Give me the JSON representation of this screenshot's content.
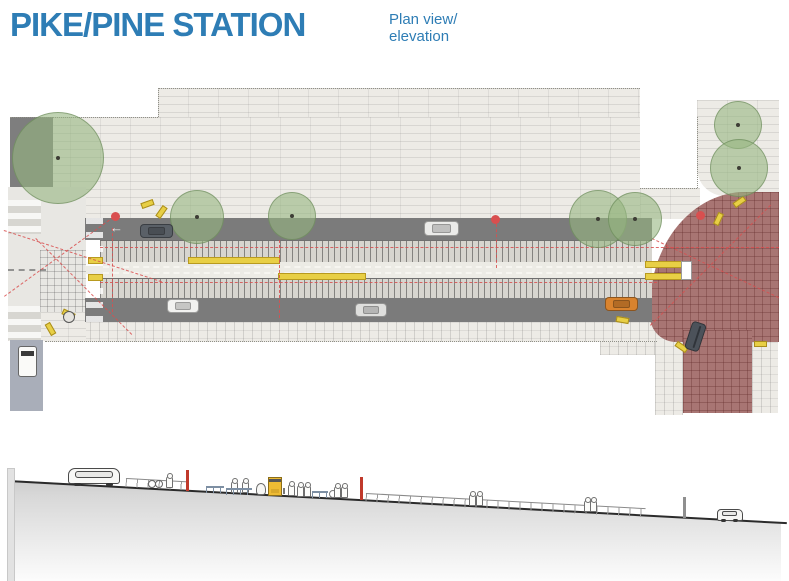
{
  "header": {
    "title": "PIKE/PINE STATION",
    "subtitle_line1": "Plan view/",
    "subtitle_line2": "elevation"
  },
  "colors": {
    "blue": "#2e7db5",
    "road": "#7b7b7b",
    "redzone": "#a87573",
    "redline": "#d94f4f",
    "yellow": "#e8cf45",
    "tree": "rgba(150,181,128,0.6)"
  },
  "plan": {
    "trees": [
      {
        "type": "tree",
        "name": "street-tree",
        "x": 57,
        "y": 157,
        "r": 45
      },
      {
        "type": "tree",
        "name": "street-tree",
        "x": 196,
        "y": 216,
        "r": 26
      },
      {
        "type": "tree",
        "name": "street-tree",
        "x": 291,
        "y": 215,
        "r": 23
      },
      {
        "type": "tree",
        "name": "street-tree",
        "x": 597,
        "y": 218,
        "r": 28
      },
      {
        "type": "tree",
        "name": "street-tree",
        "x": 634,
        "y": 218,
        "r": 26
      },
      {
        "type": "tree",
        "name": "street-tree",
        "x": 737,
        "y": 124,
        "r": 23
      },
      {
        "type": "tree",
        "name": "street-tree",
        "x": 738,
        "y": 167,
        "r": 28
      }
    ],
    "vehicles": [
      {
        "type": "car",
        "name": "car-plan",
        "x": 140,
        "y": 224,
        "w": 31,
        "h": 12,
        "color": "#5a6067"
      },
      {
        "type": "arrow",
        "name": "lane-arrow-left",
        "x": 110,
        "y": 221,
        "text": "←"
      },
      {
        "type": "car",
        "name": "car-plan",
        "x": 424,
        "y": 221,
        "w": 33,
        "h": 13,
        "color": "#ebebe9"
      },
      {
        "type": "car",
        "name": "car-plan",
        "x": 167,
        "y": 299,
        "w": 30,
        "h": 12,
        "color": "#f2f2f0"
      },
      {
        "type": "car",
        "name": "car-plan",
        "x": 355,
        "y": 303,
        "w": 30,
        "h": 12,
        "color": "#dfdfdd"
      },
      {
        "type": "car",
        "name": "car-plan",
        "x": 605,
        "y": 297,
        "w": 31,
        "h": 12,
        "color": "#d9832e"
      },
      {
        "type": "car",
        "name": "car-plan-turning",
        "x": 688,
        "y": 322,
        "w": 13,
        "h": 27,
        "rot": 18,
        "color": "#4c525a"
      },
      {
        "type": "truck",
        "name": "truck-plan",
        "x": 18,
        "y": 346,
        "w": 17,
        "h": 29,
        "color": "#fafaf8"
      }
    ],
    "marks": [
      {
        "type": "dot",
        "name": "signal-dot",
        "x": 115,
        "y": 216
      },
      {
        "type": "dot",
        "name": "signal-dot",
        "x": 495,
        "y": 219
      },
      {
        "type": "dot",
        "name": "signal-dot",
        "x": 700,
        "y": 215
      },
      {
        "type": "ramp",
        "name": "curb-ramp",
        "x": 141,
        "y": 201,
        "rot": -20
      },
      {
        "type": "ramp",
        "name": "curb-ramp",
        "x": 155,
        "y": 209,
        "rot": -55
      },
      {
        "type": "ramp",
        "name": "curb-ramp",
        "x": 62,
        "y": 311,
        "rot": 25
      },
      {
        "type": "ramp",
        "name": "curb-ramp",
        "x": 44,
        "y": 326,
        "rot": 60
      },
      {
        "type": "ramp",
        "name": "curb-ramp",
        "x": 616,
        "y": 317,
        "rot": 10
      },
      {
        "type": "ramp",
        "name": "curb-ramp",
        "x": 675,
        "y": 344,
        "rot": 35
      },
      {
        "type": "ramp",
        "name": "curb-ramp",
        "x": 754,
        "y": 341,
        "rot": 0
      },
      {
        "type": "ramp",
        "name": "curb-ramp",
        "x": 733,
        "y": 199,
        "rot": -35
      },
      {
        "type": "ramp",
        "name": "curb-ramp",
        "x": 712,
        "y": 216,
        "rot": -65
      },
      {
        "type": "manhole",
        "name": "manhole",
        "x": 63,
        "y": 311
      }
    ]
  },
  "elevation": {
    "items": [
      {
        "type": "car-rear",
        "name": "vehicle-elevation-left",
        "x": 68,
        "y": 468,
        "w": 50,
        "h": 14
      },
      {
        "type": "railing",
        "name": "railing",
        "x": 126,
        "y": 478,
        "w": 62,
        "rot": 3.1
      },
      {
        "type": "cyclist",
        "name": "cyclist",
        "x": 148,
        "y": 479
      },
      {
        "type": "fig",
        "name": "person",
        "x": 166,
        "y": 476
      },
      {
        "type": "pole",
        "name": "signal-pole-red",
        "x": 186,
        "y": 470,
        "h": 21,
        "color": "#c0392b"
      },
      {
        "type": "bench",
        "name": "bench",
        "x": 206,
        "y": 486,
        "w": 18
      },
      {
        "type": "fig",
        "name": "person",
        "x": 231,
        "y": 481
      },
      {
        "type": "fig",
        "name": "person",
        "x": 242,
        "y": 481
      },
      {
        "type": "bench",
        "name": "bench",
        "x": 226,
        "y": 488,
        "w": 26
      },
      {
        "type": "fig-round",
        "name": "person",
        "x": 256,
        "y": 483
      },
      {
        "type": "kiosk",
        "name": "ticket-kiosk",
        "x": 268,
        "y": 477
      },
      {
        "type": "post",
        "name": "bollard",
        "x": 283,
        "y": 488
      },
      {
        "type": "fig",
        "name": "person",
        "x": 288,
        "y": 484
      },
      {
        "type": "fig",
        "name": "person",
        "x": 297,
        "y": 485
      },
      {
        "type": "fig",
        "name": "person",
        "x": 304,
        "y": 485
      },
      {
        "type": "bench",
        "name": "bench",
        "x": 312,
        "y": 491,
        "w": 16
      },
      {
        "type": "bikes",
        "name": "bike-rack",
        "x": 329,
        "y": 490
      },
      {
        "type": "fig",
        "name": "person",
        "x": 334,
        "y": 486
      },
      {
        "type": "fig",
        "name": "person",
        "x": 341,
        "y": 486
      },
      {
        "type": "pole",
        "name": "signal-pole-red",
        "x": 360,
        "y": 477,
        "h": 23,
        "color": "#c0392b"
      },
      {
        "type": "railing",
        "name": "railing",
        "x": 366,
        "y": 493,
        "w": 280,
        "rot": 3.1
      },
      {
        "type": "fig",
        "name": "person",
        "x": 469,
        "y": 494
      },
      {
        "type": "fig",
        "name": "person",
        "x": 476,
        "y": 494
      },
      {
        "type": "fig",
        "name": "person",
        "x": 584,
        "y": 500
      },
      {
        "type": "fig",
        "name": "person",
        "x": 590,
        "y": 500
      },
      {
        "type": "pole",
        "name": "pole-gray",
        "x": 683,
        "y": 497,
        "h": 21,
        "color": "#8f8f8f"
      },
      {
        "type": "car-side",
        "name": "vehicle-elevation-right",
        "x": 717,
        "y": 509,
        "w": 24,
        "h": 10
      }
    ]
  }
}
